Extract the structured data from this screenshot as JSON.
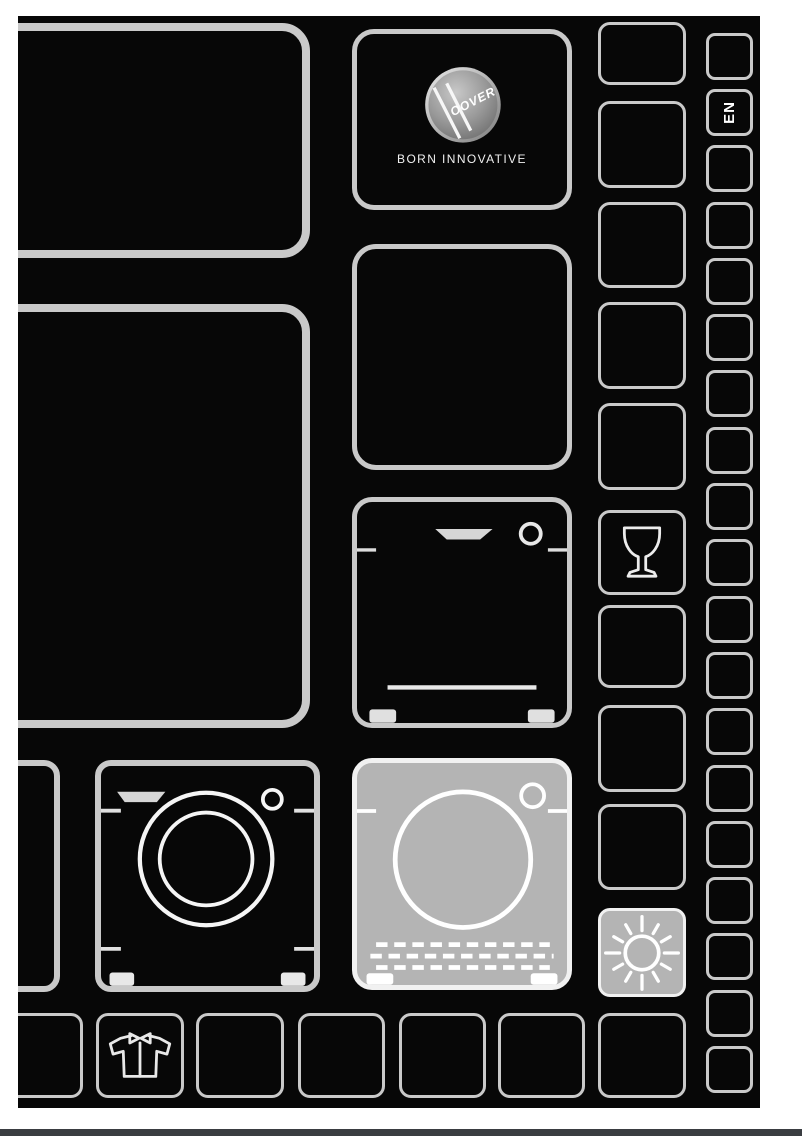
{
  "document": {
    "kind": "appliance-manual-cover",
    "language_badge": "EN",
    "brand": {
      "badge_text": "OOVER",
      "tagline": "BORN INNOVATIVE"
    }
  },
  "colors": {
    "page_bg": "#ffffff",
    "panel_bg": "#070707",
    "cell_border": "#c9c9c9",
    "highlight_border": "#f1f1f1",
    "icon_stroke": "#f5f5f5",
    "highlight_fill": "#b4b4b4",
    "badge_light": "#c8c8c8",
    "badge_dark": "#6e6e6e",
    "bottom_bar": "#3a3d41"
  },
  "grid": {
    "left_column": [
      {
        "name": "large-cell-top-left",
        "icon": null
      },
      {
        "name": "large-cell-mid-left",
        "icon": null
      },
      {
        "name": "partial-cell-left",
        "icon": null
      },
      {
        "name": "washing-machine-cell",
        "icon": "washing-machine-icon"
      }
    ],
    "appliance_column": [
      {
        "name": "brand-cell",
        "icon": "hoover-logo"
      },
      {
        "name": "empty-appliance-cell",
        "icon": null
      },
      {
        "name": "dishwasher-cell",
        "icon": "dishwasher-icon"
      },
      {
        "name": "tumble-dryer-cell",
        "icon": "tumble-dryer-icon",
        "highlighted": true
      }
    ],
    "symbol_column": [
      {
        "name": "symbol-cell-1",
        "icon": null
      },
      {
        "name": "symbol-cell-2",
        "icon": null
      },
      {
        "name": "symbol-cell-3",
        "icon": null
      },
      {
        "name": "symbol-cell-4",
        "icon": null
      },
      {
        "name": "symbol-cell-5",
        "icon": null
      },
      {
        "name": "wine-glass-cell",
        "icon": "wine-glass-icon"
      },
      {
        "name": "symbol-cell-7",
        "icon": null
      },
      {
        "name": "symbol-cell-8",
        "icon": null
      },
      {
        "name": "symbol-cell-9",
        "icon": null
      },
      {
        "name": "sun-cell",
        "icon": "sun-icon",
        "highlighted": true
      }
    ],
    "edge_column": {
      "count": 19,
      "language_cell_index": 1
    },
    "bottom_row": [
      {
        "name": "bottom-cell-1",
        "icon": null
      },
      {
        "name": "shirt-cell",
        "icon": "shirt-icon"
      },
      {
        "name": "bottom-cell-3",
        "icon": null
      },
      {
        "name": "bottom-cell-4",
        "icon": null
      },
      {
        "name": "bottom-cell-5",
        "icon": null
      },
      {
        "name": "bottom-cell-6",
        "icon": null
      },
      {
        "name": "bottom-cell-7",
        "icon": null
      }
    ]
  }
}
